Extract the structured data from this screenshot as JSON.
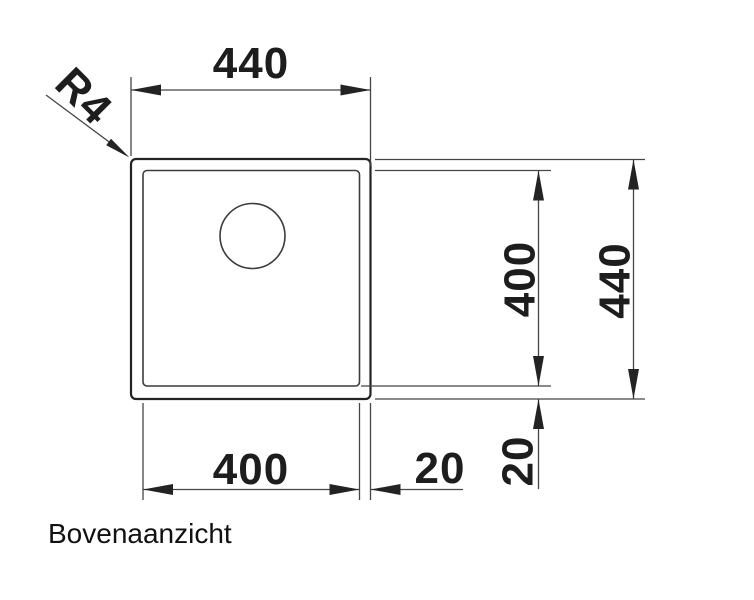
{
  "view": {
    "title": "Bovenaanzicht"
  },
  "labels": {
    "top_width": "440",
    "right_inner_height": "400",
    "right_outer_height": "440",
    "right_rim_gap": "20",
    "bottom_inner_width": "400",
    "bottom_rim_gap": "20",
    "corner_radius": "R4"
  },
  "dimensions_mm": {
    "outer_width": 440,
    "outer_height": 440,
    "inner_width": 400,
    "inner_height": 400,
    "rim_gap": 20,
    "corner_radius": 4
  },
  "colors": {
    "background": "#ffffff",
    "outline": "#232323",
    "dimension_lines": "#454545",
    "text": "#1d1d1d"
  }
}
